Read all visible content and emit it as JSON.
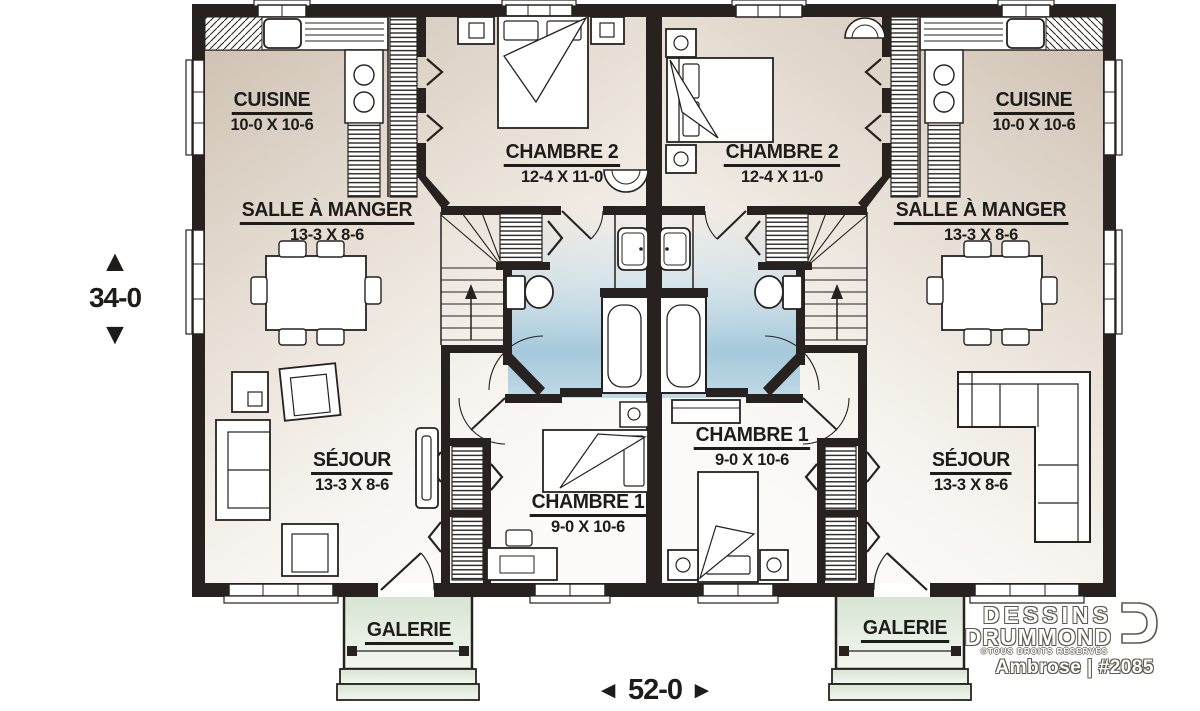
{
  "units": {
    "left": {
      "kitchen": {
        "name": "CUISINE",
        "dims": "10-0 X 10-6"
      },
      "dining": {
        "name": "SALLE À MANGER",
        "dims": "13-3 X 8-6"
      },
      "bedroom2": {
        "name": "CHAMBRE 2",
        "dims": "12-4 X 11-0"
      },
      "bedroom1": {
        "name": "CHAMBRE 1",
        "dims": "9-0 X 10-6"
      },
      "living": {
        "name": "SÉJOUR",
        "dims": "13-3 X 8-6"
      },
      "porch": {
        "name": "GALERIE"
      }
    },
    "right": {
      "kitchen": {
        "name": "CUISINE",
        "dims": "10-0 X 10-6"
      },
      "dining": {
        "name": "SALLE À MANGER",
        "dims": "13-3 X 8-6"
      },
      "bedroom2": {
        "name": "CHAMBRE 2",
        "dims": "12-4 X 11-0"
      },
      "bedroom1": {
        "name": "CHAMBRE 1",
        "dims": "9-0 X 10-6"
      },
      "living": {
        "name": "SÉJOUR",
        "dims": "13-3 X 8-6"
      },
      "porch": {
        "name": "GALERIE"
      }
    }
  },
  "dimensions": {
    "overall_depth": "34-0",
    "overall_width": "52-0"
  },
  "icons": {
    "up_arrow": "▲",
    "down_arrow": "▼",
    "left_arrow": "◄",
    "right_arrow": "►"
  },
  "branding": {
    "brand_line1": "DESSINS",
    "brand_line2": "DRUMMOND",
    "rights_notice": "©TOUS DROITS RÉSERVÉS",
    "plan_id": "Ambrose | #2085"
  },
  "colors": {
    "wall": "#272220",
    "floor_beige": "#cdbfb0",
    "bath_blue": "#9cc4da",
    "porch_green": "#d9e5d4",
    "label_text": "#1d1c1a"
  }
}
